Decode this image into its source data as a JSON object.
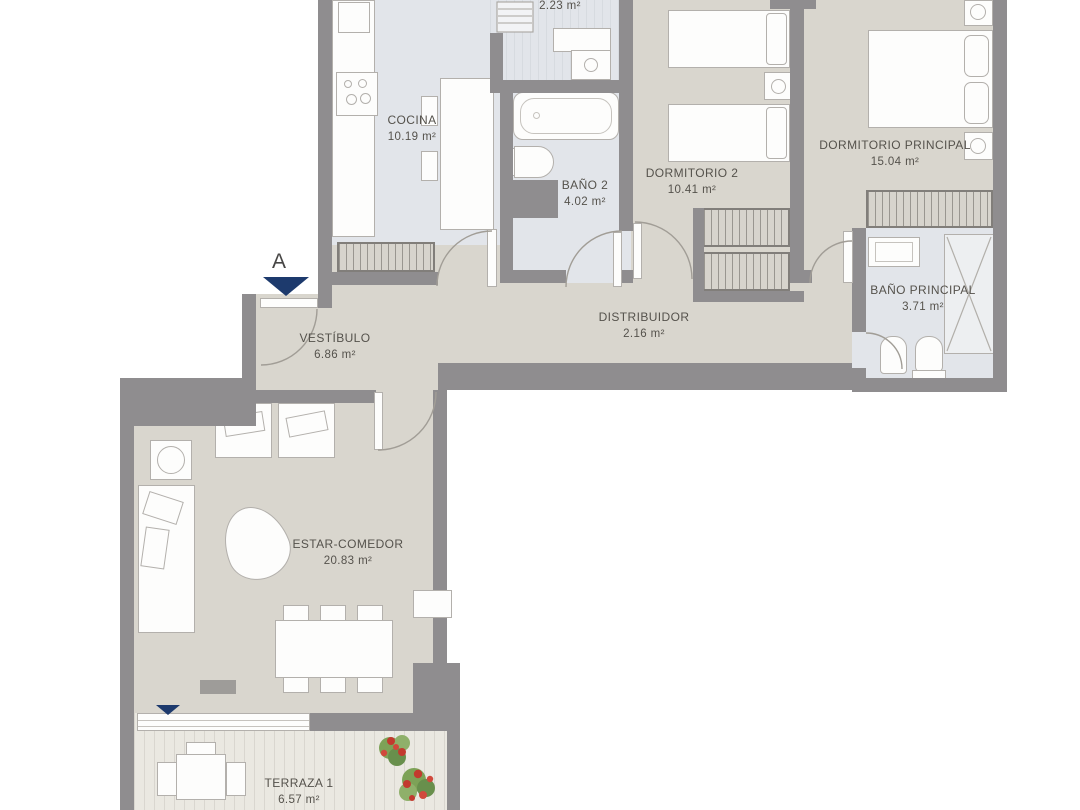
{
  "marker": {
    "letter": "A"
  },
  "rooms": {
    "lavadero": {
      "area": "2.23 m²"
    },
    "cocina": {
      "name": "COCINA",
      "area": "10.19 m²"
    },
    "bano2": {
      "name": "BAÑO 2",
      "area": "4.02 m²"
    },
    "dormitorio2": {
      "name": "DORMITORIO 2",
      "area": "10.41 m²"
    },
    "dormitorio_principal": {
      "name": "DORMITORIO PRINCIPAL",
      "area": "15.04 m²"
    },
    "bano_principal": {
      "name": "BAÑO PRINCIPAL",
      "area": "3.71 m²"
    },
    "distribuidor": {
      "name": "DISTRIBUIDOR",
      "area": "2.16 m²"
    },
    "vestibulo": {
      "name": "VESTÍBULO",
      "area": "6.86 m²"
    },
    "estar_comedor": {
      "name": "ESTAR-COMEDOR",
      "area": "20.83 m²"
    },
    "terraza1": {
      "name": "TERRAZA 1",
      "area": "6.57 m²"
    }
  },
  "colors": {
    "wall": "#8f8d8f",
    "floor": "#d9d6ce",
    "wet_floor": "#e2e5ea",
    "deck": "#eae8e1",
    "accent_navy": "#1d3a6d",
    "text": "#55524c"
  }
}
